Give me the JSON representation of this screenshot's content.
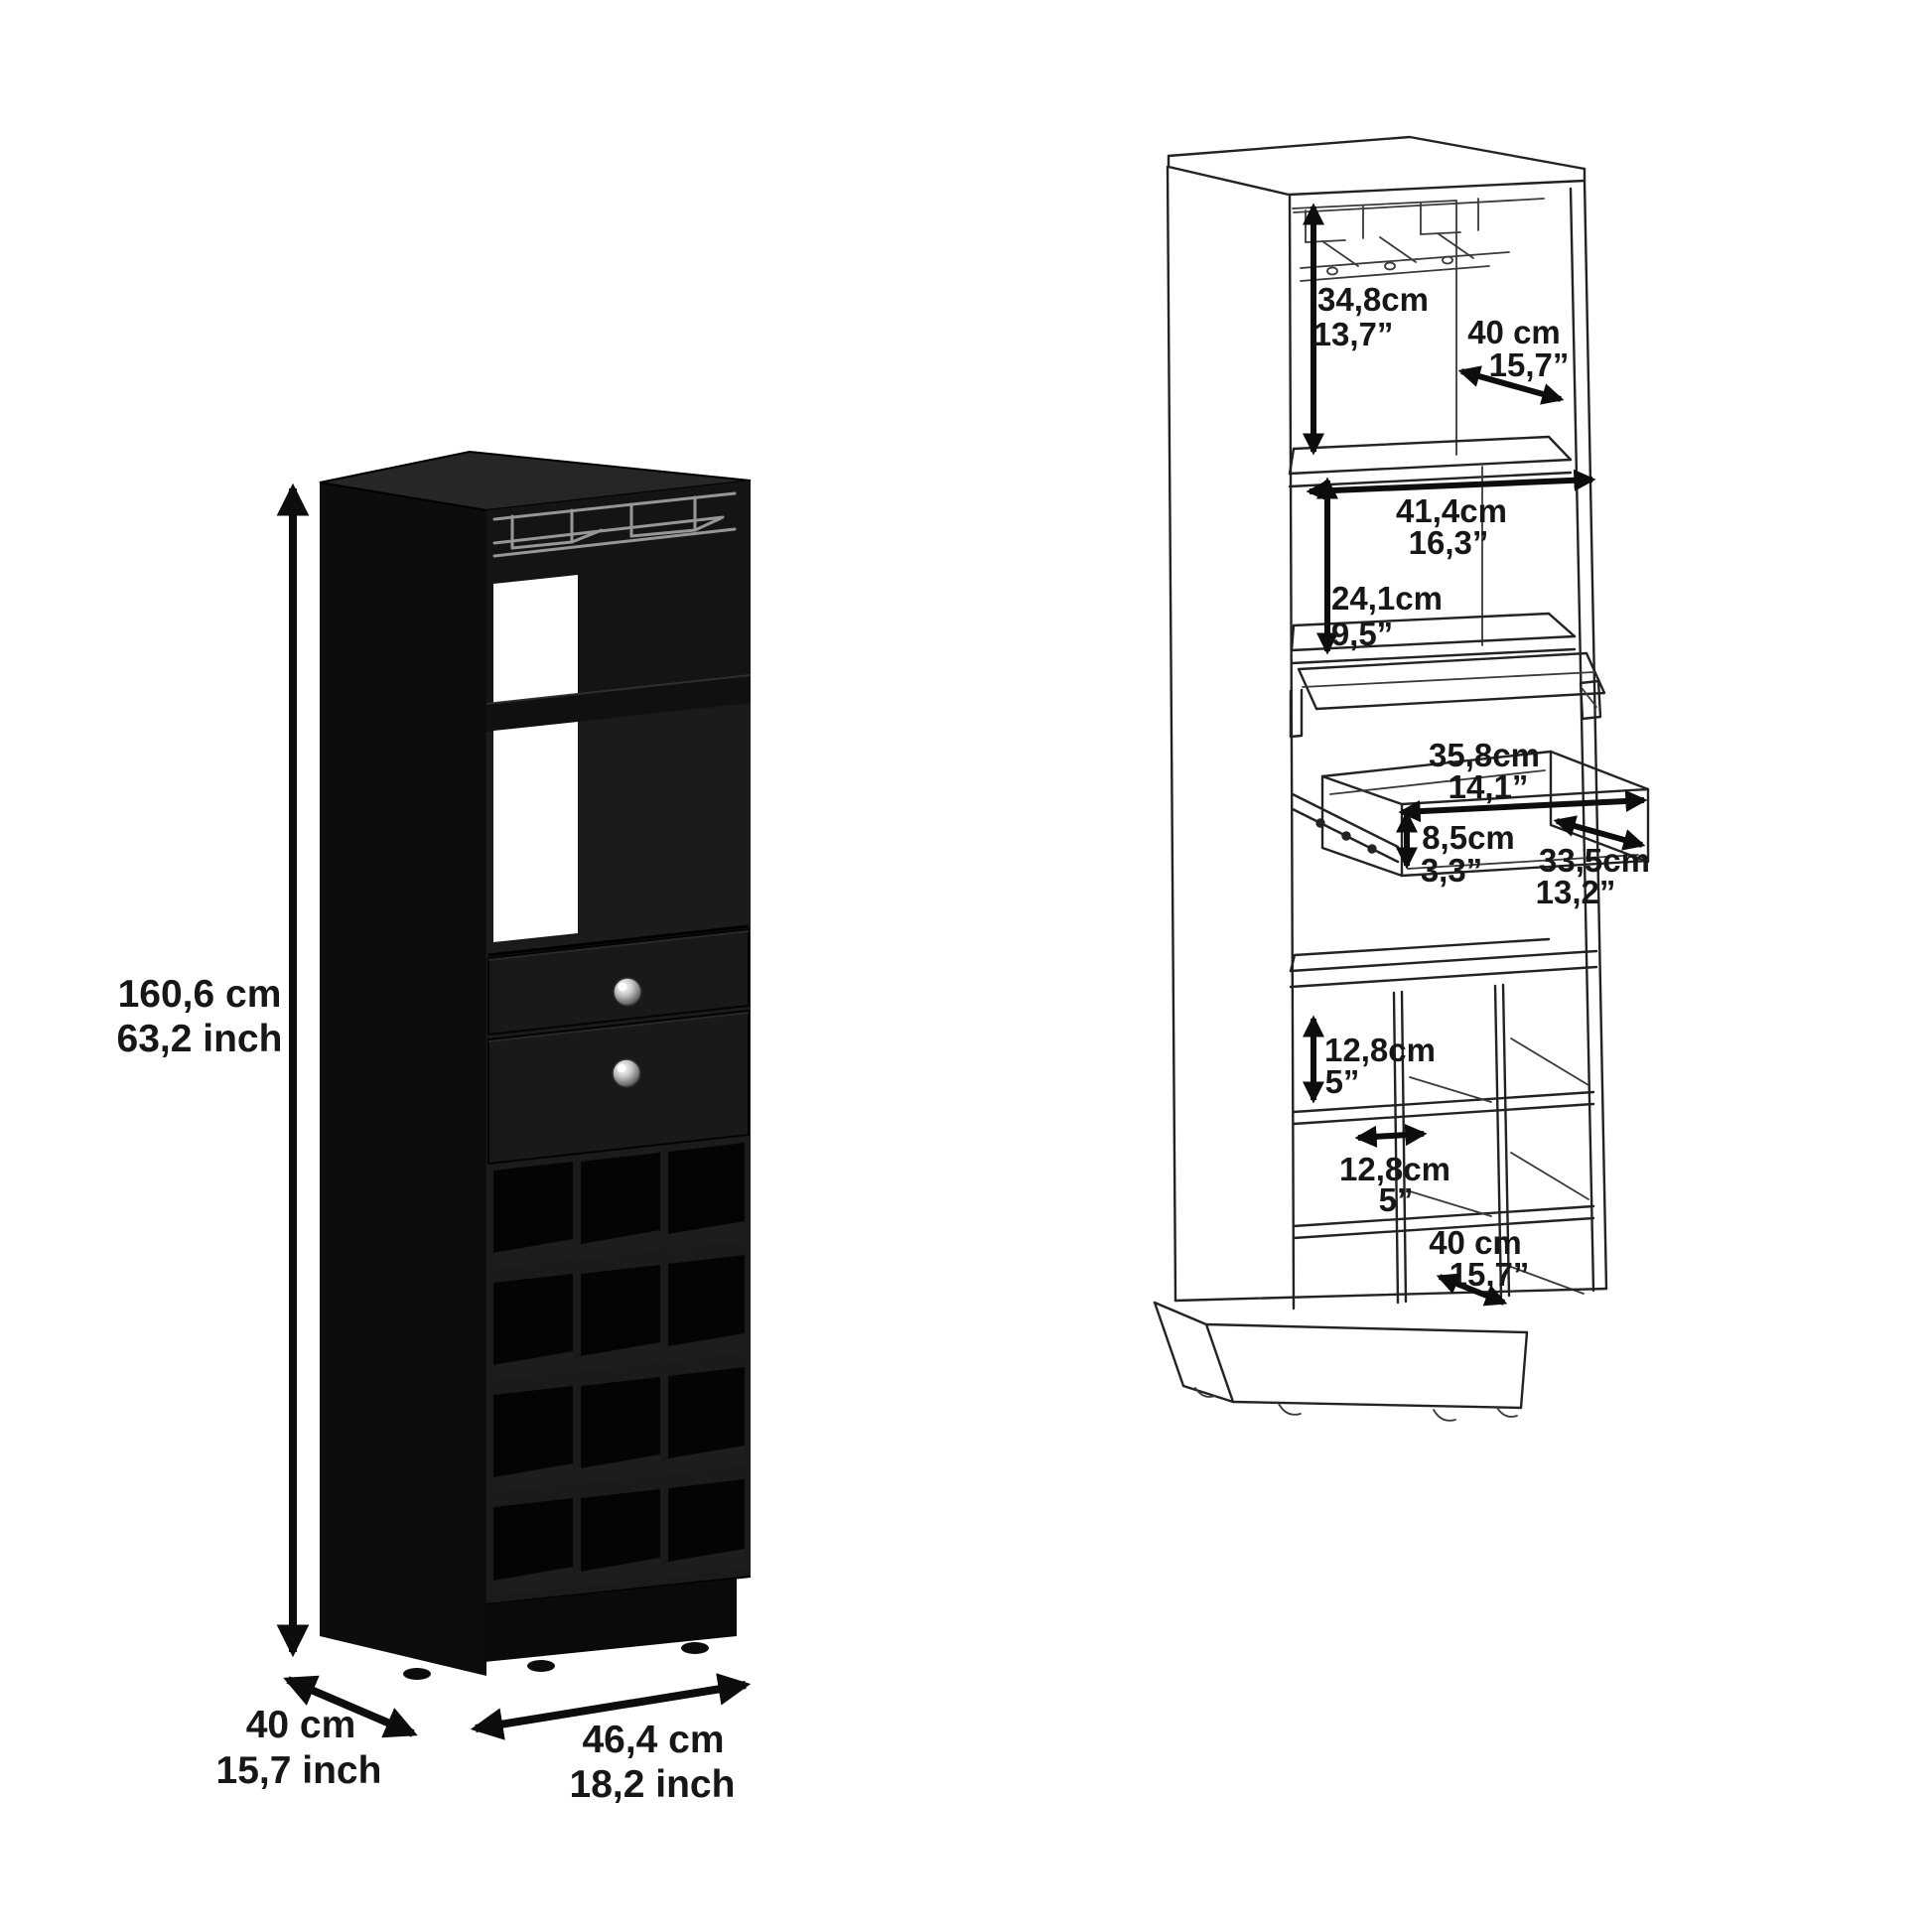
{
  "colors": {
    "background": "#ffffff",
    "cabinet_black": "#1b1b1b",
    "cabinet_side_black": "#0d0d0d",
    "line_art": "#232323",
    "dimension_text": "#171717",
    "knob_silver": "#c9c9c9"
  },
  "render_view": {
    "height": {
      "cm": "160,6 cm",
      "inch": "63,2 inch"
    },
    "depth": {
      "cm": "40 cm",
      "inch": "15,7 inch"
    },
    "width": {
      "cm": "46,4 cm",
      "inch": "18,2 inch"
    }
  },
  "diagram_view": {
    "rack_clearance": {
      "cm": "34,8cm",
      "inch": "13,7”"
    },
    "top_depth": {
      "cm": "40 cm",
      "inch": "15,7”"
    },
    "shelf_width": {
      "cm": "41,4cm",
      "inch": "16,3”"
    },
    "shelf_clearance": {
      "cm": "24,1cm",
      "inch": "9,5”"
    },
    "drawer_width": {
      "cm": "35,8cm",
      "inch": "14,1”"
    },
    "drawer_height": {
      "cm": "8,5cm",
      "inch": "3,3”"
    },
    "drawer_depth": {
      "cm": "33,5cm",
      "inch": "13,2”"
    },
    "cubby_height": {
      "cm": "12,8cm",
      "inch": "5”"
    },
    "cubby_width": {
      "cm": "12,8cm",
      "inch": "5”"
    },
    "base_depth": {
      "cm": "40 cm",
      "inch": "15,7”"
    }
  }
}
